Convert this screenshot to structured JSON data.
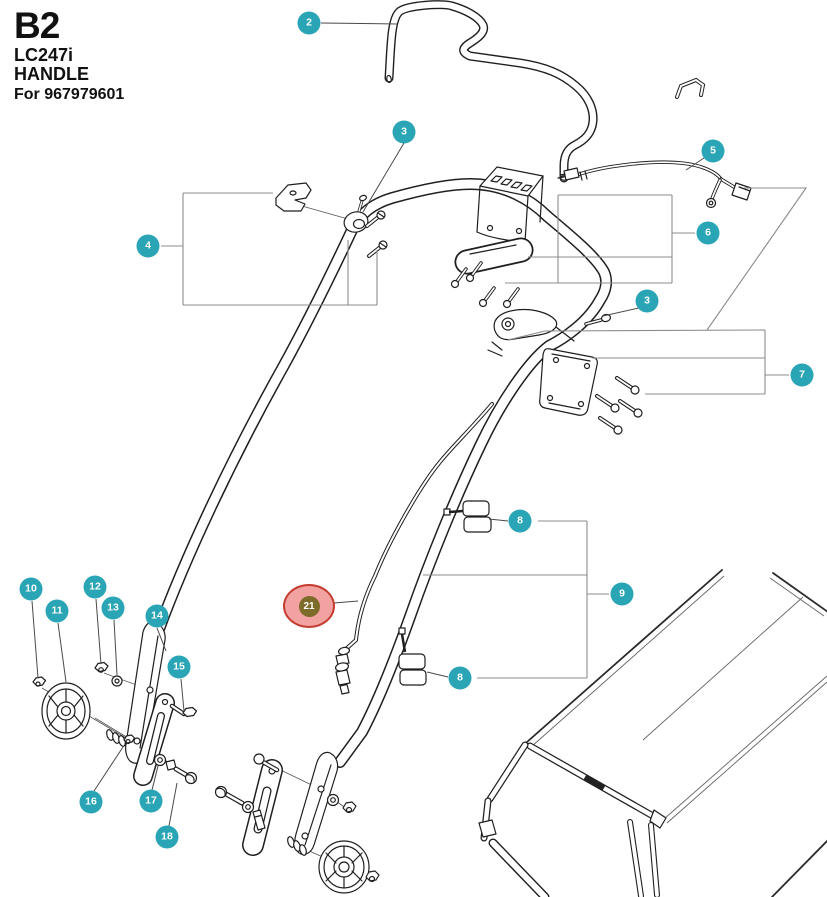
{
  "title": {
    "code": "B2",
    "model": "LC247i",
    "name": "HANDLE",
    "for_text": "For 967979601"
  },
  "colors": {
    "badge_teal": "#2aa5b5",
    "badge_text": "#ffffff",
    "highlight_fill": "#f2a2a0",
    "highlight_ring": "#c43c30",
    "highlight_badge": "#7d6b2a",
    "line_art": "#1f1f1f",
    "bracket_gray": "#8c8c8c"
  },
  "callouts": [
    {
      "number": "2"
    },
    {
      "number": "3"
    },
    {
      "number": "4"
    },
    {
      "number": "5"
    },
    {
      "number": "6"
    },
    {
      "number": "3"
    },
    {
      "number": "7"
    },
    {
      "number": "8"
    },
    {
      "number": "9"
    },
    {
      "number": "8"
    },
    {
      "number": "10"
    },
    {
      "number": "11"
    },
    {
      "number": "12"
    },
    {
      "number": "13"
    },
    {
      "number": "14"
    },
    {
      "number": "15"
    },
    {
      "number": "16"
    },
    {
      "number": "17"
    },
    {
      "number": "18"
    },
    {
      "number": "21",
      "highlighted": true
    }
  ]
}
